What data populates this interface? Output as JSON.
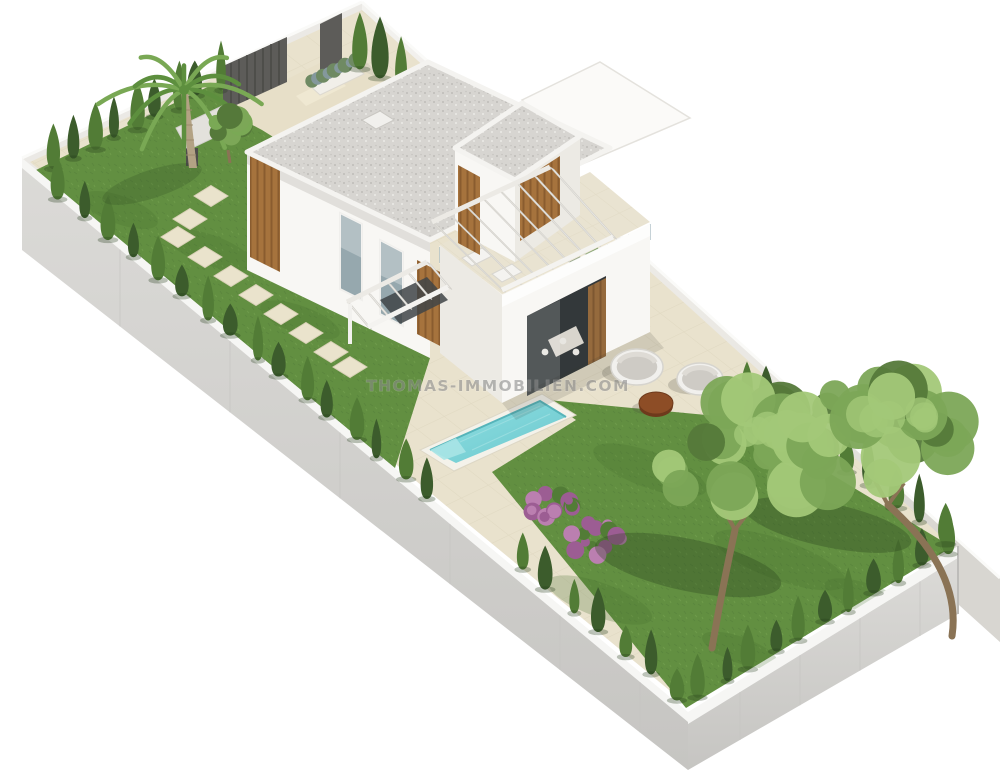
{
  "meta": {
    "title": "3D architectural rendering of a modern villa plot",
    "view": "isometric aerial view",
    "subject": "Two-storey white villa with walled garden, swimming pool, sun terrace and lawn",
    "background": "#ffffff"
  },
  "watermark": {
    "text": "THOMAS-IMMOBILIEN.COM",
    "x": 498,
    "y": 391,
    "opacity": 0.58
  },
  "palette": {
    "bg": "#ffffff",
    "grass": "#628f41",
    "grass_light": "#7aa955",
    "grass_dark": "#49702f",
    "hedge_dark": "#3c5c2c",
    "hedge_light": "#527c36",
    "olive_mid": "#7ca757",
    "olive_light": "#a3c878",
    "olive_dark": "#55793a",
    "trunk": "#8a7355",
    "palm_trunk": "#b3a284",
    "palm_leaf": "#5d8f3e",
    "palm_leaf_light": "#79a854",
    "paving": "#e9e2cd",
    "paving_joint": "#d7cfb6",
    "drive": "#e7dfc8",
    "wall_top": "#f6f6f4",
    "wall_outer": "#d6d5d2",
    "wall_outer_dark": "#c2c1be",
    "wall_inner": "#ebe9e5",
    "wall_ne": "#f2f1ee",
    "wall_ne_shadow": "#d8d6d1",
    "house_white": "#f8f7f4",
    "house_shade": "#eceae4",
    "house_dark": "#dedcd6",
    "roof_gravel": "#d7d5d1",
    "gravel_dot_dark": "#bfbdb9",
    "gravel_dot_light": "#ecebe7",
    "wood": "#a6733d",
    "wood_dark": "#8a5c2f",
    "glass": "#bcd3da",
    "glass_frame": "#f0efec",
    "window_glass": "#96a8ae",
    "window_dark": "#5f6e74",
    "opening_dark": "#33383a",
    "pool_water": "#7fd5d9",
    "pool_light": "#a9e4e6",
    "pool_dark": "#56b4ba",
    "coping": "#f4f2ea",
    "gate_dark": "#5d5c59",
    "cushion": "#cecbc5",
    "daybed_frame": "#f1f0ed",
    "table_top": "#8d4d26",
    "table_side": "#6e3a1c",
    "flower": "#9c5d93",
    "flower_light": "#bb7fb0",
    "lavender": "#84989c",
    "wm_color": "#8a8a8a"
  },
  "scene": {
    "plot_corners": {
      "west": [
        22,
        158
      ],
      "north": [
        362,
        2
      ],
      "east": [
        958,
        546
      ],
      "south": [
        688,
        712
      ]
    },
    "stepping_stones": {
      "w": 34,
      "h": 21,
      "positions": [
        [
          211,
          196
        ],
        [
          190,
          219
        ],
        [
          178,
          237
        ],
        [
          205,
          257
        ],
        [
          231,
          276
        ],
        [
          256,
          295
        ],
        [
          281,
          314
        ],
        [
          306,
          333
        ],
        [
          331,
          352
        ],
        [
          350,
          367
        ]
      ]
    },
    "hedge_rows": [
      {
        "name": "hedge-nw-wall",
        "x1": 52,
        "y1": 168,
        "x2": 218,
        "y2": 88,
        "count": 9,
        "w": 15,
        "h": 40
      },
      {
        "name": "hedge-gate-side",
        "x1": 358,
        "y1": 68,
        "x2": 400,
        "y2": 88,
        "count": 3,
        "w": 18,
        "h": 52
      },
      {
        "name": "hedge-sw-upper",
        "x1": 58,
        "y1": 198,
        "x2": 428,
        "y2": 498,
        "count": 16,
        "w": 15,
        "h": 36
      },
      {
        "name": "hedge-sw-lower",
        "x1": 520,
        "y1": 568,
        "x2": 676,
        "y2": 698,
        "count": 7,
        "w": 15,
        "h": 36
      },
      {
        "name": "hedge-se-wall",
        "x1": 700,
        "y1": 696,
        "x2": 946,
        "y2": 552,
        "count": 11,
        "w": 15,
        "h": 36
      },
      {
        "name": "hedge-ne-rear",
        "x1": 744,
        "y1": 398,
        "x2": 944,
        "y2": 542,
        "count": 9,
        "w": 16,
        "h": 40
      },
      {
        "name": "hedge-terrace-wall",
        "x1": 548,
        "y1": 250,
        "x2": 642,
        "y2": 324,
        "count": 5,
        "w": 18,
        "h": 46
      },
      {
        "name": "hedge-behind-roof",
        "x1": 448,
        "y1": 110,
        "x2": 474,
        "y2": 132,
        "count": 3,
        "w": 13,
        "h": 30
      }
    ],
    "palm_tree": {
      "base": [
        193,
        168
      ],
      "top": [
        184,
        90
      ],
      "fronds": 12,
      "frond_len": 72
    },
    "small_tree": {
      "cx": 228,
      "cy": 126,
      "r": 23
    },
    "olive_trees": [
      {
        "name": "olive-tree-left",
        "cx": 742,
        "cy": 455,
        "rx": 88,
        "ry": 68,
        "trunk": [
          [
            712,
            648
          ],
          [
            735,
            530
          ]
        ]
      },
      {
        "name": "olive-tree-right",
        "cx": 872,
        "cy": 438,
        "rx": 95,
        "ry": 62,
        "trunk": [
          [
            952,
            636
          ],
          [
            888,
            505
          ]
        ]
      }
    ],
    "tree_shadows": [
      {
        "cx": 688,
        "cy": 565,
        "rx": 95,
        "ry": 26
      },
      {
        "cx": 828,
        "cy": 525,
        "rx": 85,
        "ry": 22
      }
    ],
    "flower_shrubs": [
      {
        "cx": 548,
        "cy": 508,
        "r": 27
      },
      {
        "cx": 594,
        "cy": 541,
        "r": 30
      }
    ],
    "lavender_planter": {
      "quad": [
        [
          308,
          84
        ],
        [
          352,
          63
        ],
        [
          364,
          74
        ],
        [
          320,
          95
        ]
      ],
      "blobs": 9
    },
    "pool": {
      "coping": [
        [
          420,
          450
        ],
        [
          542,
          394
        ],
        [
          576,
          415
        ],
        [
          454,
          471
        ]
      ],
      "water": [
        [
          430,
          450
        ],
        [
          540,
          401
        ],
        [
          566,
          417
        ],
        [
          456,
          463
        ]
      ],
      "label": "swimming pool"
    },
    "furniture": {
      "daybeds": [
        {
          "name": "round-daybed-left",
          "cx": 637,
          "cy": 367,
          "rx": 26,
          "ry": 18
        },
        {
          "name": "round-daybed-right",
          "cx": 700,
          "cy": 379,
          "rx": 23,
          "ry": 16
        }
      ],
      "coffee_table": {
        "cx": 656,
        "cy": 403,
        "rx": 17,
        "ry": 11
      },
      "roof_loungers": [
        {
          "cx": 476,
          "cy": 258
        },
        {
          "cx": 506,
          "cy": 274
        }
      ]
    },
    "pergola_main": {
      "edgeA": [
        [
          432,
          222
        ],
        [
          550,
          167
        ]
      ],
      "edgeB": [
        [
          502,
          290
        ],
        [
          613,
          237
        ]
      ],
      "beams": 8
    },
    "pergola_entry": {
      "edgeA": [
        [
          347,
          302
        ],
        [
          427,
          262
        ]
      ],
      "edgeB": [
        [
          368,
          327
        ],
        [
          448,
          287
        ]
      ],
      "beams": 5
    },
    "glass_railings": [
      {
        "name": "terrace-railing-sw",
        "p1": [
          440,
          247
        ],
        "p2": [
          502,
          295
        ],
        "drop": 16,
        "posts": 4
      },
      {
        "name": "terrace-railing-se",
        "p1": [
          502,
          295
        ],
        "p2": [
          650,
          224
        ],
        "drop": 16,
        "posts": 7
      }
    ],
    "wall_joint_lines": {
      "sw_xs": [
        120,
        230,
        340,
        450,
        560,
        640
      ],
      "se_xs": [
        740,
        800,
        860,
        920
      ]
    },
    "gate": {
      "fence_quad": [
        [
          223,
          66
        ],
        [
          287,
          37
        ],
        [
          287,
          82
        ],
        [
          223,
          111
        ]
      ],
      "door_quad": [
        [
          320,
          24
        ],
        [
          342,
          13
        ],
        [
          342,
          64
        ],
        [
          320,
          75
        ]
      ]
    },
    "grass_blotches": [
      [
        120,
        210,
        40,
        14
      ],
      [
        210,
        250,
        46,
        15
      ],
      [
        300,
        320,
        42,
        14
      ],
      [
        150,
        280,
        30,
        10
      ],
      [
        650,
        470,
        60,
        18
      ],
      [
        780,
        560,
        70,
        20
      ],
      [
        600,
        600,
        55,
        17
      ],
      [
        870,
        600,
        48,
        15
      ],
      [
        740,
        650,
        40,
        13
      ]
    ],
    "labels": {
      "villa": "modern white villa",
      "garden": "walled garden",
      "terrace": "sun terrace",
      "driveway": "entrance driveway",
      "lawn": "rear lawn",
      "stones": "stepping stone path"
    }
  }
}
